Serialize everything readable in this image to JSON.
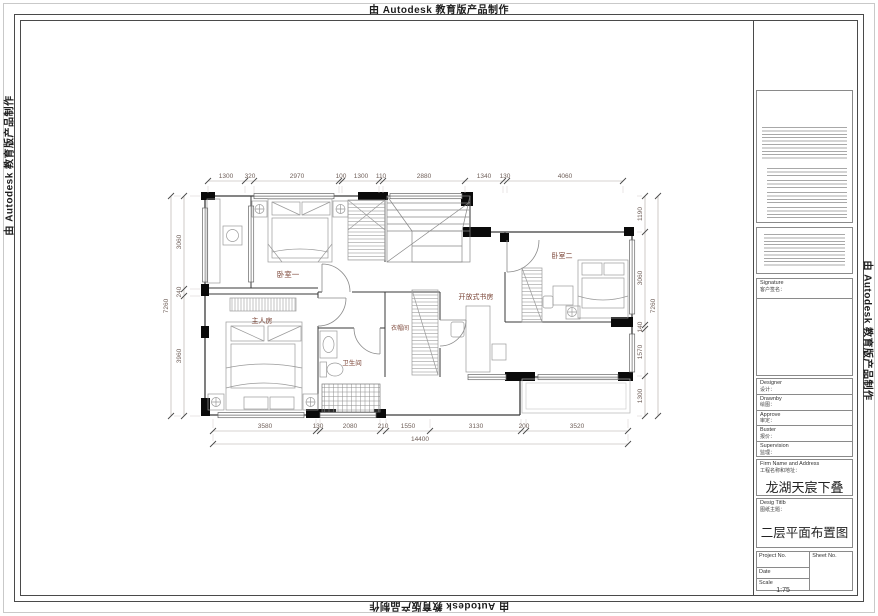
{
  "banner": {
    "text": "由 Autodesk 教育版产品制作"
  },
  "plan": {
    "rooms": {
      "bedroom1": "卧室一",
      "master": "主人房",
      "bathroom": "卫生间",
      "cloakroom": "衣帽间",
      "study": "开放式书房",
      "bedroom2": "卧室二"
    },
    "dims": {
      "top": [
        "1300",
        "320",
        "2970",
        "100",
        "1300",
        "110",
        "2880",
        "1340",
        "130",
        "4060"
      ],
      "bottom": [
        "3580",
        "130",
        "2080",
        "210",
        "1550",
        "3130",
        "200",
        "3520"
      ],
      "bottom_total": "14400",
      "left": [
        "3060",
        "240",
        "3960"
      ],
      "left_total": "7260",
      "right": [
        "1190",
        "3060",
        "140",
        "1570",
        "1300"
      ],
      "right_total": "7260"
    }
  },
  "titleblock": {
    "signature": {
      "en": "Signature",
      "zh": "客户签名："
    },
    "fields": [
      {
        "en": "Designer",
        "zh": "设计："
      },
      {
        "en": "Drawnby",
        "zh": "绘图："
      },
      {
        "en": "Approve",
        "zh": "审定："
      },
      {
        "en": "Buster",
        "zh": "报价："
      },
      {
        "en": "Supervision",
        "zh": "监理："
      }
    ],
    "firm": {
      "en": "Firm Name and Address",
      "zh": "工程名称和地址："
    },
    "project_name": "龙湖天宸下叠",
    "desig": {
      "en": "Desig Titlb",
      "zh": "图纸主题："
    },
    "drawing_title": "二层平面布置图",
    "table": {
      "project_no": "Project No.",
      "sheet_no": "Sheet No.",
      "date": "Date",
      "scale": "Scale",
      "scale_value": "1:75"
    }
  }
}
